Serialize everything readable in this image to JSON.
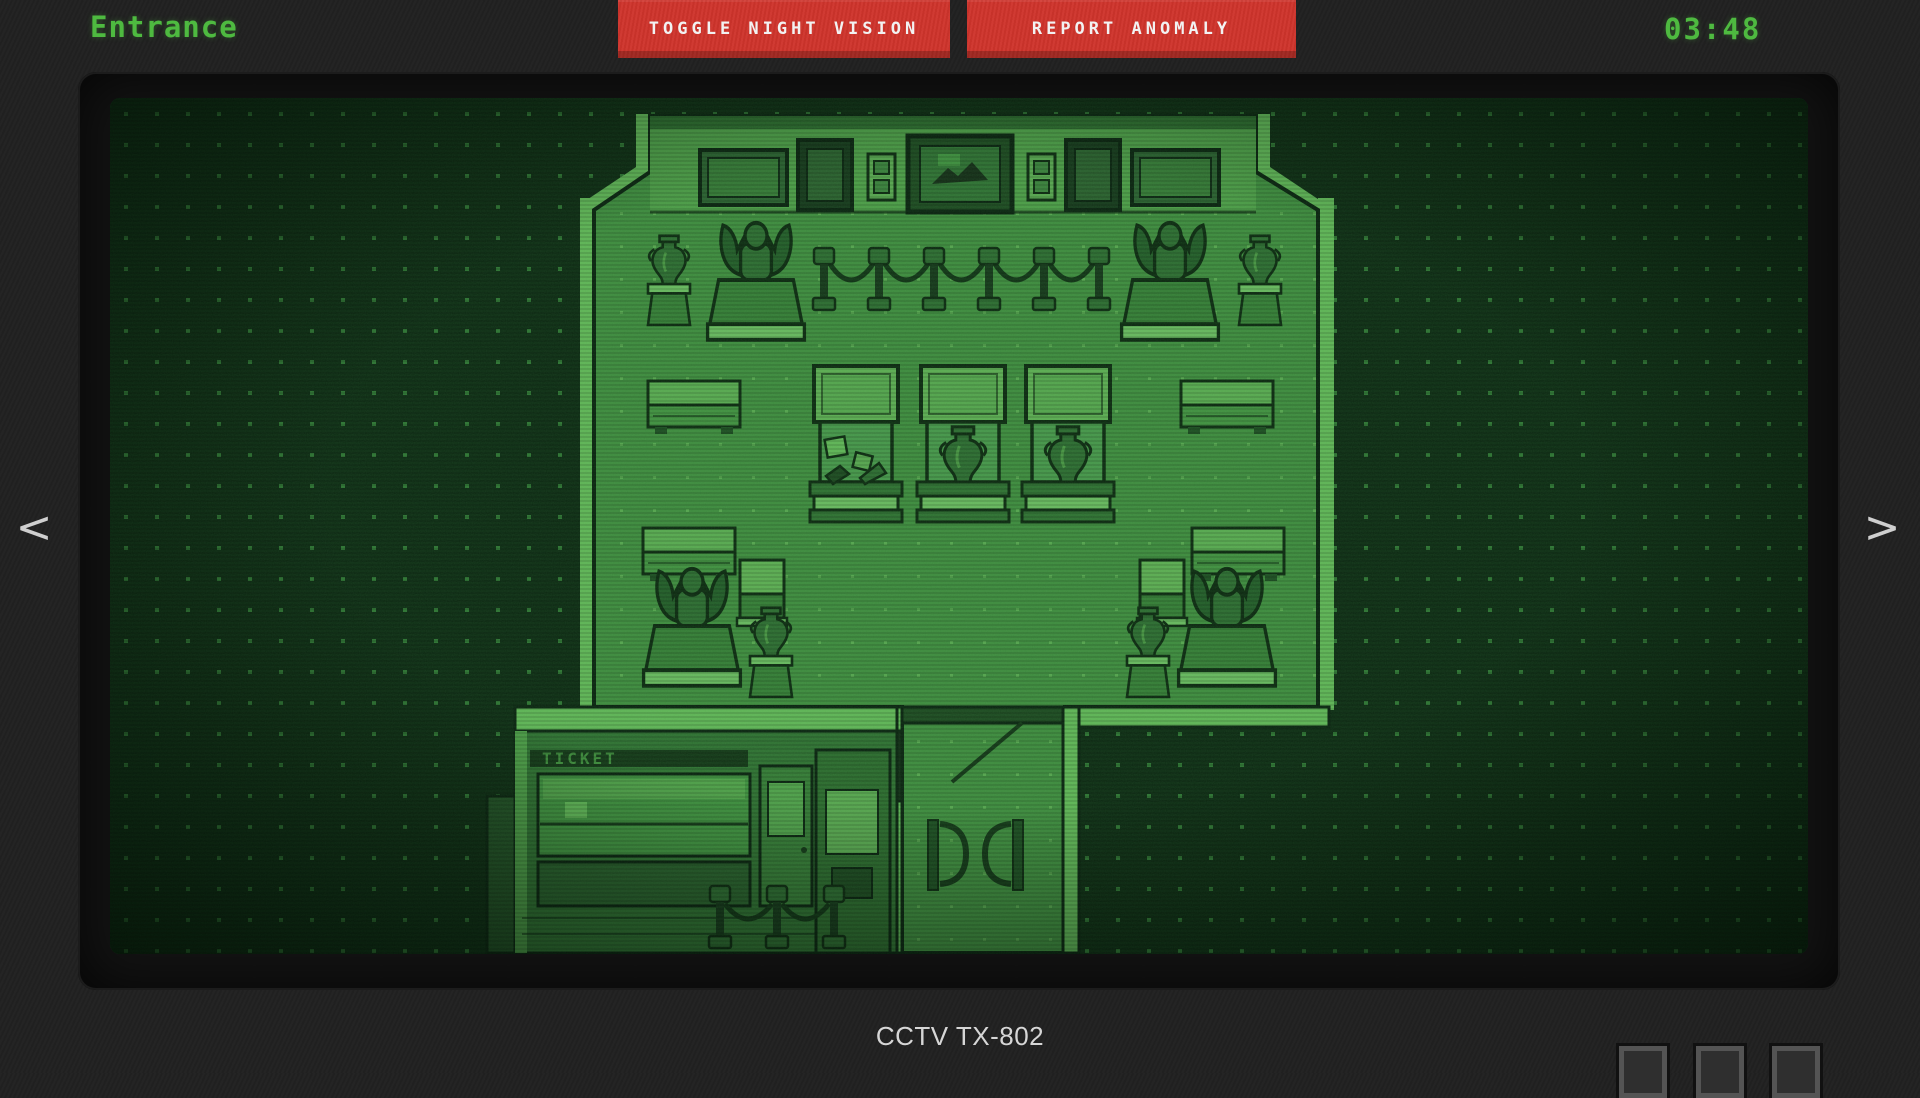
{
  "header": {
    "camera_name": "Entrance",
    "toggle_night_vision_label": "TOGGLE NIGHT VISION",
    "report_anomaly_label": "REPORT ANOMALY",
    "clock": "03:48"
  },
  "nav": {
    "prev_label": "<",
    "next_label": ">"
  },
  "scene": {
    "ticket_sign": "TICKET",
    "description": "night-vision top-down pixel-art museum entrance hall"
  },
  "footer": {
    "camera_id": "CCTV TX-802",
    "monitor_button_count": 3
  },
  "colors": {
    "accent_green": "#4eba40",
    "button_red": "#cf342c",
    "night_exterior": "#0e2d14",
    "floor_green": "#3e8a3e",
    "wall_highlight": "#5fb356",
    "outline_dark": "#0e2c12"
  }
}
